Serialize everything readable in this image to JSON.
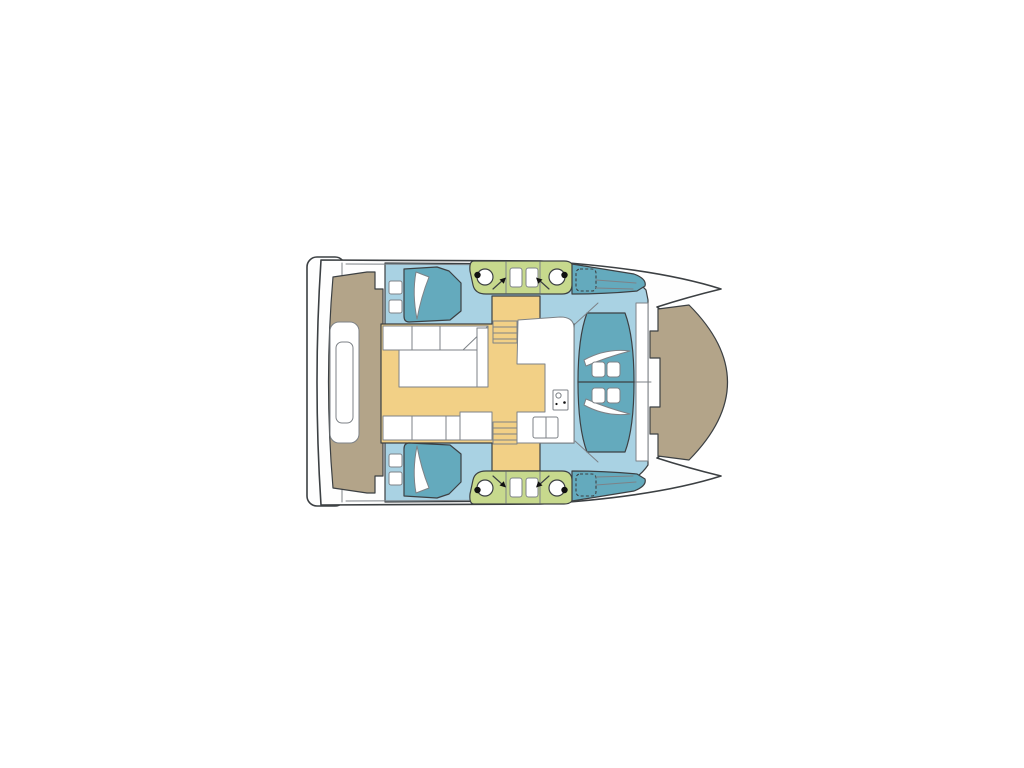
{
  "colors": {
    "page_bg": "#ffffff",
    "hull_fill": "#fefefe",
    "outline": "#3c4043",
    "inner_line": "#7d8287",
    "cabin_floor": "#a9d2e3",
    "cushion_teal": "#64aabd",
    "bathroom_green": "#c7d98d",
    "saloon_yellow": "#f2d086",
    "deck_tan": "#b3a489",
    "furniture_white": "#ffffff",
    "toilet_black": "#111111"
  }
}
